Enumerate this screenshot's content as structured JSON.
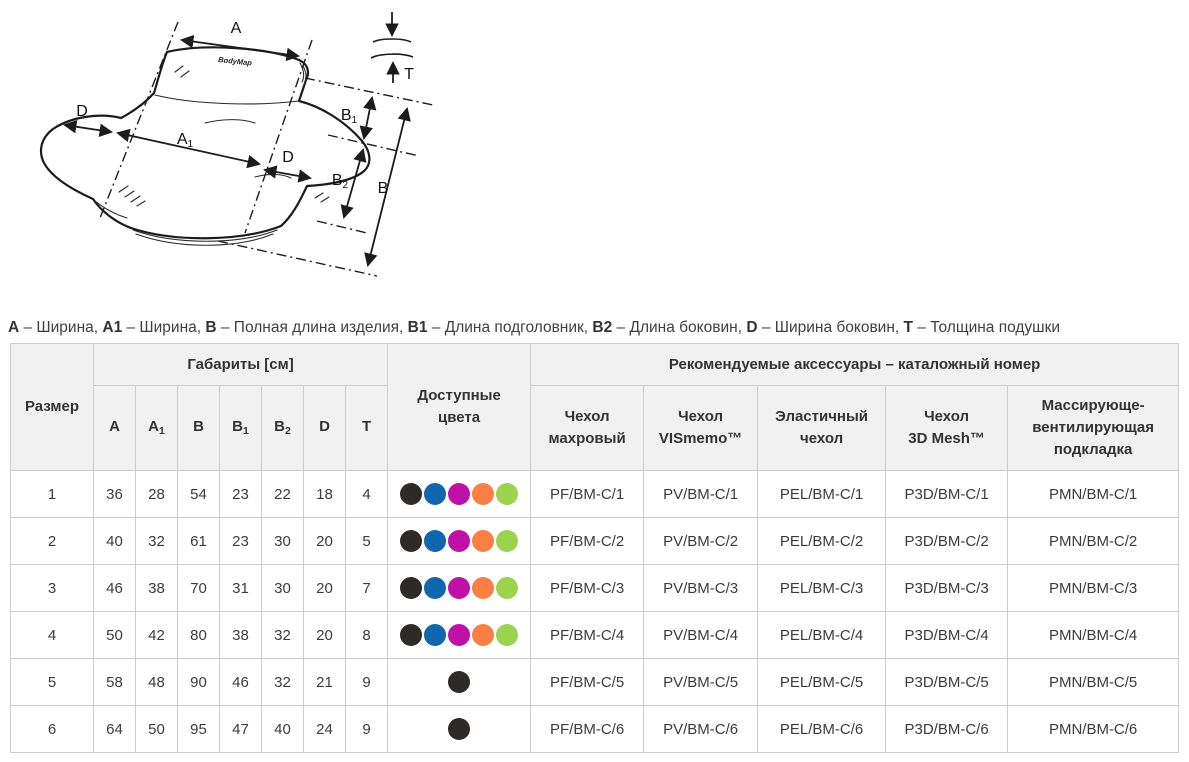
{
  "diagram": {
    "logo": "BodyMap",
    "labels": {
      "a": "A",
      "a1": {
        "b": "A",
        "s": "1"
      },
      "b": "B",
      "b1": {
        "b": "B",
        "s": "1"
      },
      "b2": {
        "b": "B",
        "s": "2"
      },
      "d_left": "D",
      "d_mid": "D",
      "t": "T"
    }
  },
  "legend": {
    "parts": [
      {
        "key": "A",
        "desc": "Ширина"
      },
      {
        "key": "A1",
        "desc": "Ширина"
      },
      {
        "key": "B",
        "desc": "Полная длина изделия"
      },
      {
        "key": "B1",
        "desc": "Длина подголовник"
      },
      {
        "key": "B2",
        "desc": "Длина боковин"
      },
      {
        "key": "D",
        "desc": "Ширина боковин"
      },
      {
        "key": "T",
        "desc": "Толщина подушки"
      }
    ],
    "separator": " – "
  },
  "table": {
    "headers": {
      "size": "Размер",
      "dimensions_group": "Габариты [см]",
      "dimension_cols": [
        {
          "b": "A",
          "s": ""
        },
        {
          "b": "A",
          "s": "1"
        },
        {
          "b": "B",
          "s": ""
        },
        {
          "b": "B",
          "s": "1"
        },
        {
          "b": "B",
          "s": "2"
        },
        {
          "b": "D",
          "s": ""
        },
        {
          "b": "T",
          "s": ""
        }
      ],
      "colors_lines": [
        "Доступные",
        "цвета"
      ],
      "accessories_group": "Рекомендуемые аксессуары – каталожный номер",
      "accessory_cols_lines": [
        [
          "Чехол",
          "махровый"
        ],
        [
          "Чехол",
          "VISmemo™"
        ],
        [
          "Эластичный",
          "чехол"
        ],
        [
          "Чехол",
          "3D Mesh™"
        ],
        [
          "Массирующе-",
          "вентилирующая",
          "подкладка"
        ]
      ]
    },
    "color_palette": {
      "black": "#2d2a28",
      "blue": "#1166b0",
      "magenta": "#bf11a7",
      "orange": "#f97f42",
      "green": "#9ad44f"
    },
    "rows": [
      {
        "size": "1",
        "dims": [
          "36",
          "28",
          "54",
          "23",
          "22",
          "18",
          "4"
        ],
        "colors": [
          "black",
          "blue",
          "magenta",
          "orange",
          "green"
        ],
        "accessories": [
          "PF/BM-C/1",
          "PV/BM-C/1",
          "PEL/BM-C/1",
          "P3D/BM-C/1",
          "PMN/BM-C/1"
        ]
      },
      {
        "size": "2",
        "dims": [
          "40",
          "32",
          "61",
          "23",
          "30",
          "20",
          "5"
        ],
        "colors": [
          "black",
          "blue",
          "magenta",
          "orange",
          "green"
        ],
        "accessories": [
          "PF/BM-C/2",
          "PV/BM-C/2",
          "PEL/BM-C/2",
          "P3D/BM-C/2",
          "PMN/BM-C/2"
        ]
      },
      {
        "size": "3",
        "dims": [
          "46",
          "38",
          "70",
          "31",
          "30",
          "20",
          "7"
        ],
        "colors": [
          "black",
          "blue",
          "magenta",
          "orange",
          "green"
        ],
        "accessories": [
          "PF/BM-C/3",
          "PV/BM-C/3",
          "PEL/BM-C/3",
          "P3D/BM-C/3",
          "PMN/BM-C/3"
        ]
      },
      {
        "size": "4",
        "dims": [
          "50",
          "42",
          "80",
          "38",
          "32",
          "20",
          "8"
        ],
        "colors": [
          "black",
          "blue",
          "magenta",
          "orange",
          "green"
        ],
        "accessories": [
          "PF/BM-C/4",
          "PV/BM-C/4",
          "PEL/BM-C/4",
          "P3D/BM-C/4",
          "PMN/BM-C/4"
        ]
      },
      {
        "size": "5",
        "dims": [
          "58",
          "48",
          "90",
          "46",
          "32",
          "21",
          "9"
        ],
        "colors": [
          "black"
        ],
        "accessories": [
          "PF/BM-C/5",
          "PV/BM-C/5",
          "PEL/BM-C/5",
          "P3D/BM-C/5",
          "PMN/BM-C/5"
        ]
      },
      {
        "size": "6",
        "dims": [
          "64",
          "50",
          "95",
          "47",
          "40",
          "24",
          "9"
        ],
        "colors": [
          "black"
        ],
        "accessories": [
          "PF/BM-C/6",
          "PV/BM-C/6",
          "PEL/BM-C/6",
          "P3D/BM-C/6",
          "PMN/BM-C/6"
        ]
      }
    ]
  }
}
